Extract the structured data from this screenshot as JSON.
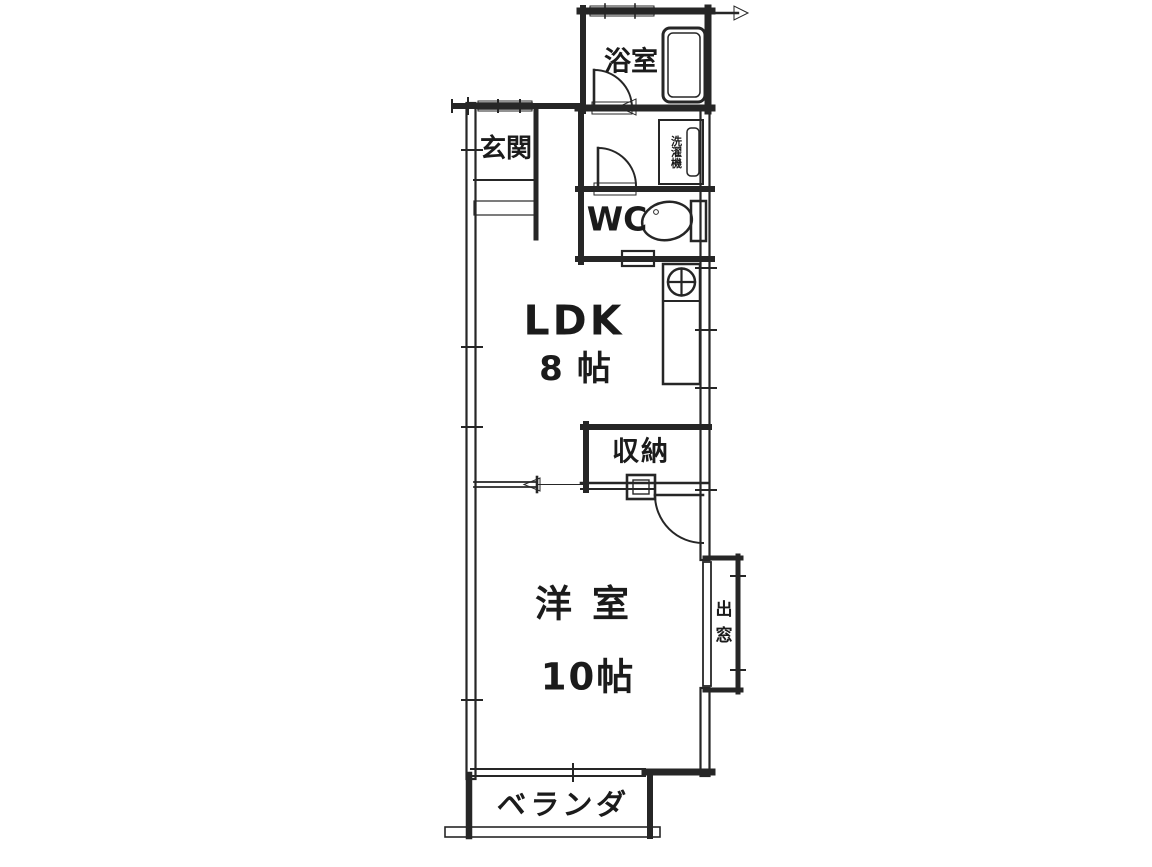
{
  "rooms": {
    "genkan": {
      "label": "玄関"
    },
    "bathroom": {
      "label": "浴室"
    },
    "laundry": {
      "label": "洗濯機"
    },
    "wc": {
      "label": "WC"
    },
    "ldk": {
      "label": "LDK",
      "size": "8帖"
    },
    "storage": {
      "label": "収納"
    },
    "western_room": {
      "label": "洋室",
      "size": "10帖"
    },
    "bay_window": {
      "label": "出窓"
    },
    "veranda": {
      "label": "ベランダ"
    }
  },
  "fixtures": [
    "bathtub-icon",
    "toilet-icon",
    "kitchen-sink-icon",
    "washing-machine-icon"
  ],
  "colors": {
    "ink": "#262626",
    "text": "#1b1b1b",
    "paper": "#ffffff"
  }
}
